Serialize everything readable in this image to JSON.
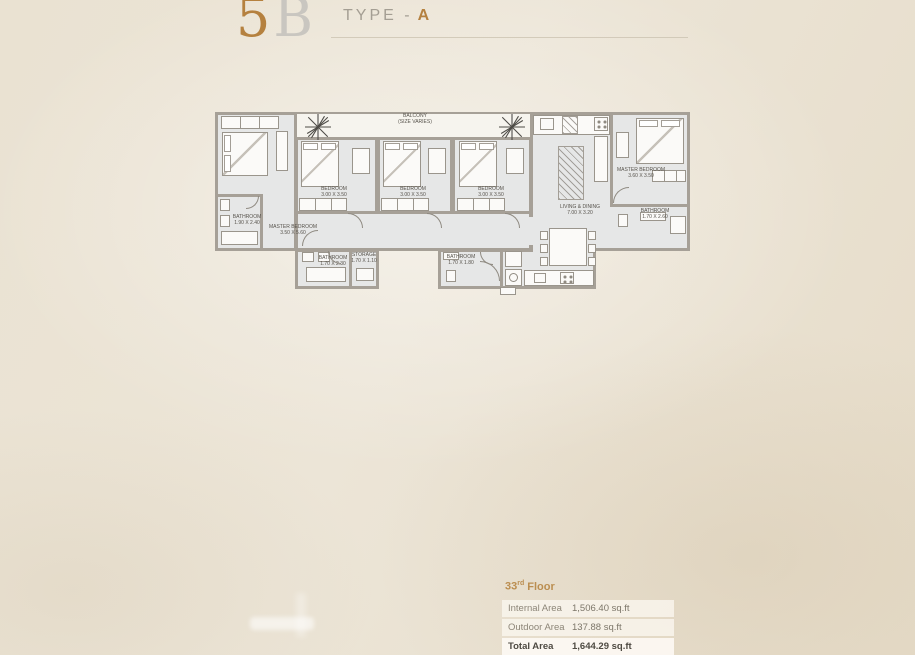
{
  "header": {
    "unit_first": "5",
    "unit_rest": "B",
    "type_label": "TYPE -",
    "type_value": "A"
  },
  "plan": {
    "balcony_name": "BALCONY",
    "balcony_size": "(SIZE VARIES)",
    "rooms": [
      {
        "name": "MASTER BEDROOM",
        "dims": "3.50 X 5.60"
      },
      {
        "name": "BATHROOM",
        "dims": "1.90 X 2.40"
      },
      {
        "name": "BEDROOM",
        "dims": "3.00 X 3.50"
      },
      {
        "name": "BEDROOM",
        "dims": "3.00 X 3.50"
      },
      {
        "name": "BEDROOM",
        "dims": "3.00 X 3.50"
      },
      {
        "name": "LIVING & DINING",
        "dims": "7.00 X 3.20"
      },
      {
        "name": "MASTER BEDROOM",
        "dims": "3.60 X 3.50"
      },
      {
        "name": "BATHROOM",
        "dims": "1.70 X 2.60"
      },
      {
        "name": "BATHROOM",
        "dims": "1.70 X 2.30"
      },
      {
        "name": "STORAGE",
        "dims": "1.70 X 1.10"
      },
      {
        "name": "BATHROOM",
        "dims": "1.70 X 1.80"
      }
    ]
  },
  "area_table": {
    "floor_number": "33",
    "floor_ordinal": "rd",
    "floor_word": "Floor",
    "rows": [
      {
        "label": "Internal Area",
        "value": "1,506.40 sq.ft"
      },
      {
        "label": "Outdoor Area",
        "value": "137.88 sq.ft"
      },
      {
        "label": "Total Area",
        "value": "1,644.29 sq.ft"
      }
    ]
  },
  "colors": {
    "accent_gold": "#b5813f",
    "wall_gray": "#a6a097",
    "floor_fill": "#e6e7e7",
    "background": "#eae2d2"
  }
}
